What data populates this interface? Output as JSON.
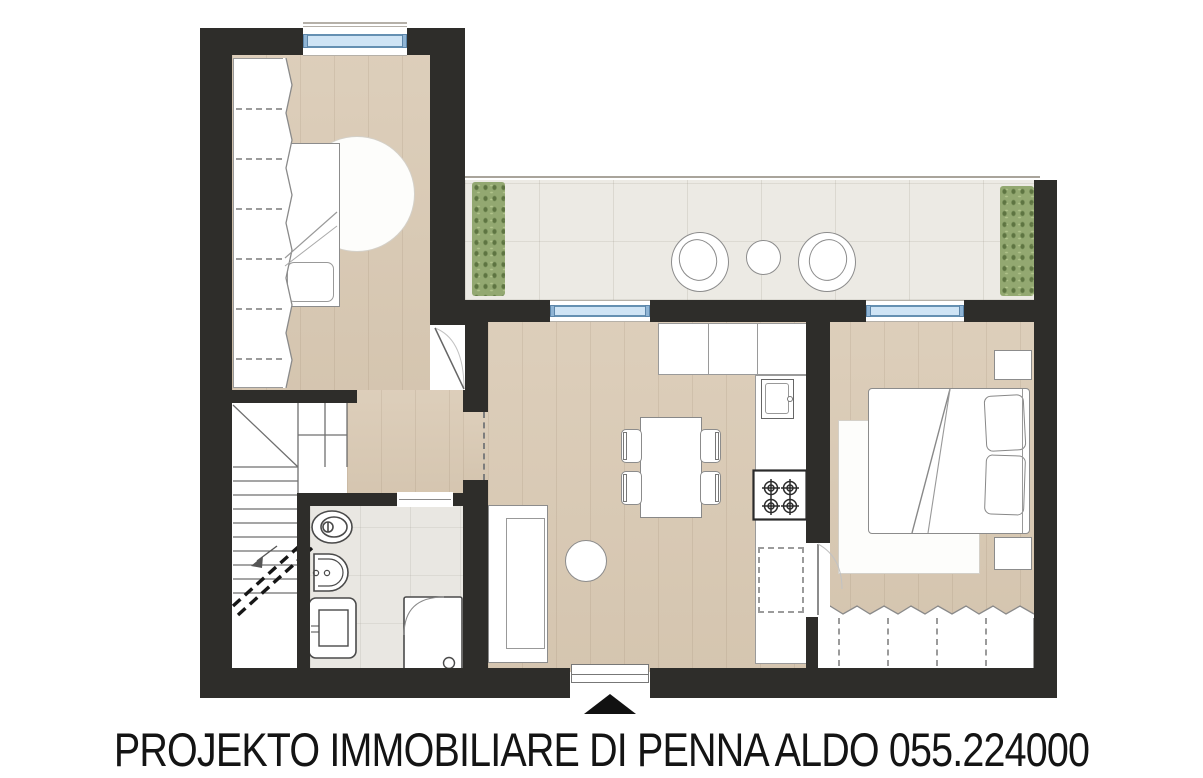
{
  "caption": {
    "text": "PROJEKTO IMMOBILIARE DI PENNA ALDO 055.224000"
  },
  "plan": {
    "type": "apartment-floor-plan",
    "rooms": [
      {
        "name": "bedroom-top-left",
        "furniture": [
          "wardrobe",
          "single-bed",
          "round-rug"
        ]
      },
      {
        "name": "terrace",
        "furniture": [
          "hedge-left",
          "round-chair",
          "round-side-table",
          "round-chair",
          "hedge-right"
        ]
      },
      {
        "name": "living-kitchen",
        "furniture": [
          "upper-cabinets",
          "corner-cabinet",
          "sink",
          "cooktop",
          "built-in-appliance",
          "dining-table",
          "four-chairs",
          "sofa",
          "round-pouf"
        ]
      },
      {
        "name": "bedroom-right",
        "furniture": [
          "double-bed",
          "pillows",
          "rug",
          "nightstand",
          "nightstand",
          "wardrobe"
        ]
      },
      {
        "name": "bathroom",
        "furniture": [
          "toilet",
          "bidet",
          "washbasin",
          "shower"
        ]
      },
      {
        "name": "staircase",
        "furniture": [
          "winder-steps",
          "direction-arrow",
          "break-line"
        ]
      },
      {
        "name": "corridor",
        "furniture": []
      }
    ],
    "markers": [
      "entrance-arrow",
      "entrance-threshold",
      "window",
      "window",
      "window",
      "door-swing",
      "terrace-railing"
    ]
  },
  "colors": {
    "wall": "#2e2d2a",
    "wood_floor": "#d9c9b3",
    "terrace_stone": "#eceae4",
    "bathroom_tile": "#e9e7e2",
    "hedge_green": "#93a871",
    "window_fill": "#cfe4f5",
    "window_frame": "#6590b2",
    "furniture_fill": "#ffffff",
    "furniture_outline": "#8c8c8c",
    "text": "#141414"
  }
}
